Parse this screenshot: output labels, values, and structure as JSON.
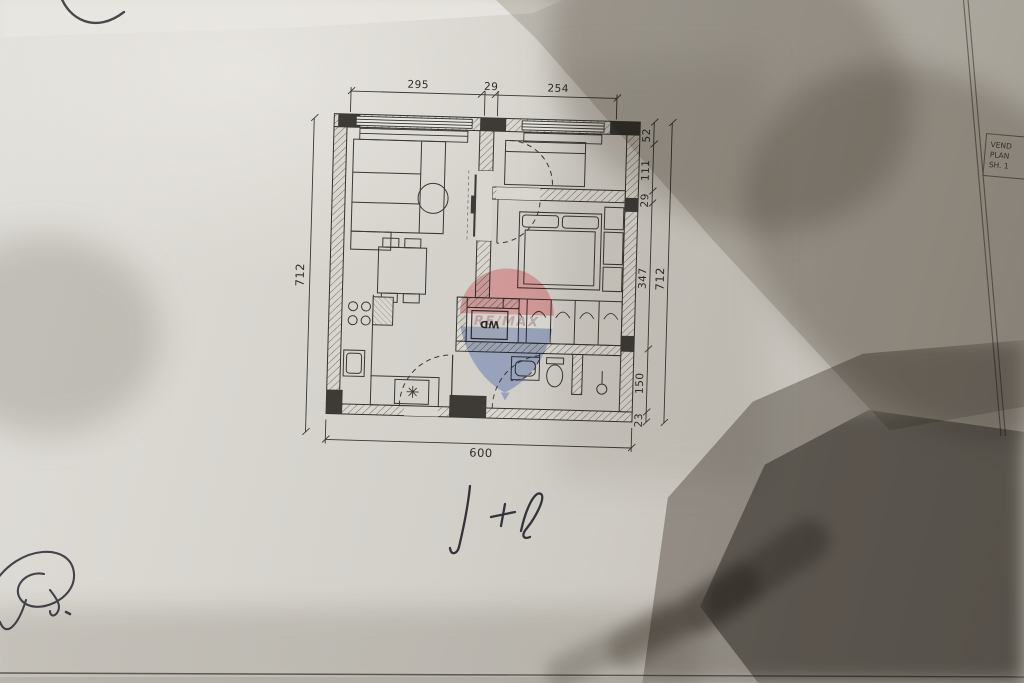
{
  "annotations": {
    "unit_label": "1+1"
  },
  "floor_plan": {
    "dim_top": [
      "295",
      "29",
      "254"
    ],
    "dim_bottom": "600",
    "dim_left": "712",
    "dim_right_inner": [
      "52",
      "111",
      "29",
      "347",
      "150",
      "23"
    ],
    "dim_right_outer": "712",
    "appliance_label": "WD",
    "watermark_brand": "RE/MAX"
  },
  "title_block": {
    "line1": "VEND",
    "line2": "PLAN",
    "line3": "SH. 1"
  },
  "colors": {
    "paper": "#d6d3cd",
    "ink": "#35332f",
    "watermark_red": "#cf4a52",
    "watermark_blue": "#3a5ba0",
    "shadow": "#6e675f"
  }
}
